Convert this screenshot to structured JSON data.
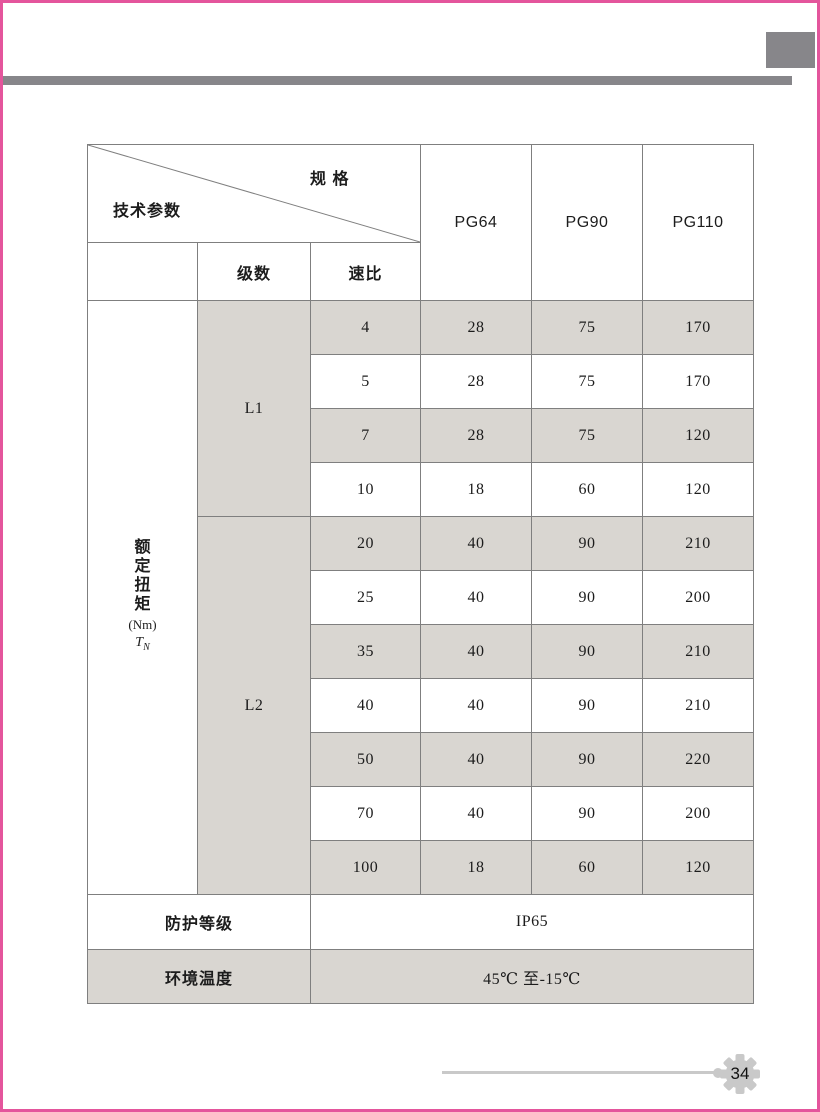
{
  "page": {
    "number": "34",
    "accent_pink": "#e4559c",
    "accent_gray": "#87868a",
    "shade_color": "#d9d6d1"
  },
  "table": {
    "corner": {
      "top_right_label": "规 格",
      "bottom_left_label": "技术参数"
    },
    "spec_columns": [
      "PG64",
      "PG90",
      "PG110"
    ],
    "stage_header": "级数",
    "ratio_header": "速比",
    "torque_label": {
      "chars": [
        "额",
        "定",
        "扭",
        "矩"
      ],
      "unit": "(Nm)",
      "symbol": "T",
      "symbol_sub": "N"
    },
    "groups": [
      {
        "label": "L1",
        "rows": [
          {
            "ratio": "4",
            "values": [
              "28",
              "75",
              "170"
            ]
          },
          {
            "ratio": "5",
            "values": [
              "28",
              "75",
              "170"
            ]
          },
          {
            "ratio": "7",
            "values": [
              "28",
              "75",
              "120"
            ]
          },
          {
            "ratio": "10",
            "values": [
              "18",
              "60",
              "120"
            ]
          }
        ]
      },
      {
        "label": "L2",
        "rows": [
          {
            "ratio": "20",
            "values": [
              "40",
              "90",
              "210"
            ]
          },
          {
            "ratio": "25",
            "values": [
              "40",
              "90",
              "200"
            ]
          },
          {
            "ratio": "35",
            "values": [
              "40",
              "90",
              "210"
            ]
          },
          {
            "ratio": "40",
            "values": [
              "40",
              "90",
              "210"
            ]
          },
          {
            "ratio": "50",
            "values": [
              "40",
              "90",
              "220"
            ]
          },
          {
            "ratio": "70",
            "values": [
              "40",
              "90",
              "200"
            ]
          },
          {
            "ratio": "100",
            "values": [
              "18",
              "60",
              "120"
            ]
          }
        ]
      }
    ],
    "footer_rows": [
      {
        "label": "防护等级",
        "value": "IP65"
      },
      {
        "label": "环境温度",
        "value": "45℃ 至-15℃"
      }
    ]
  }
}
